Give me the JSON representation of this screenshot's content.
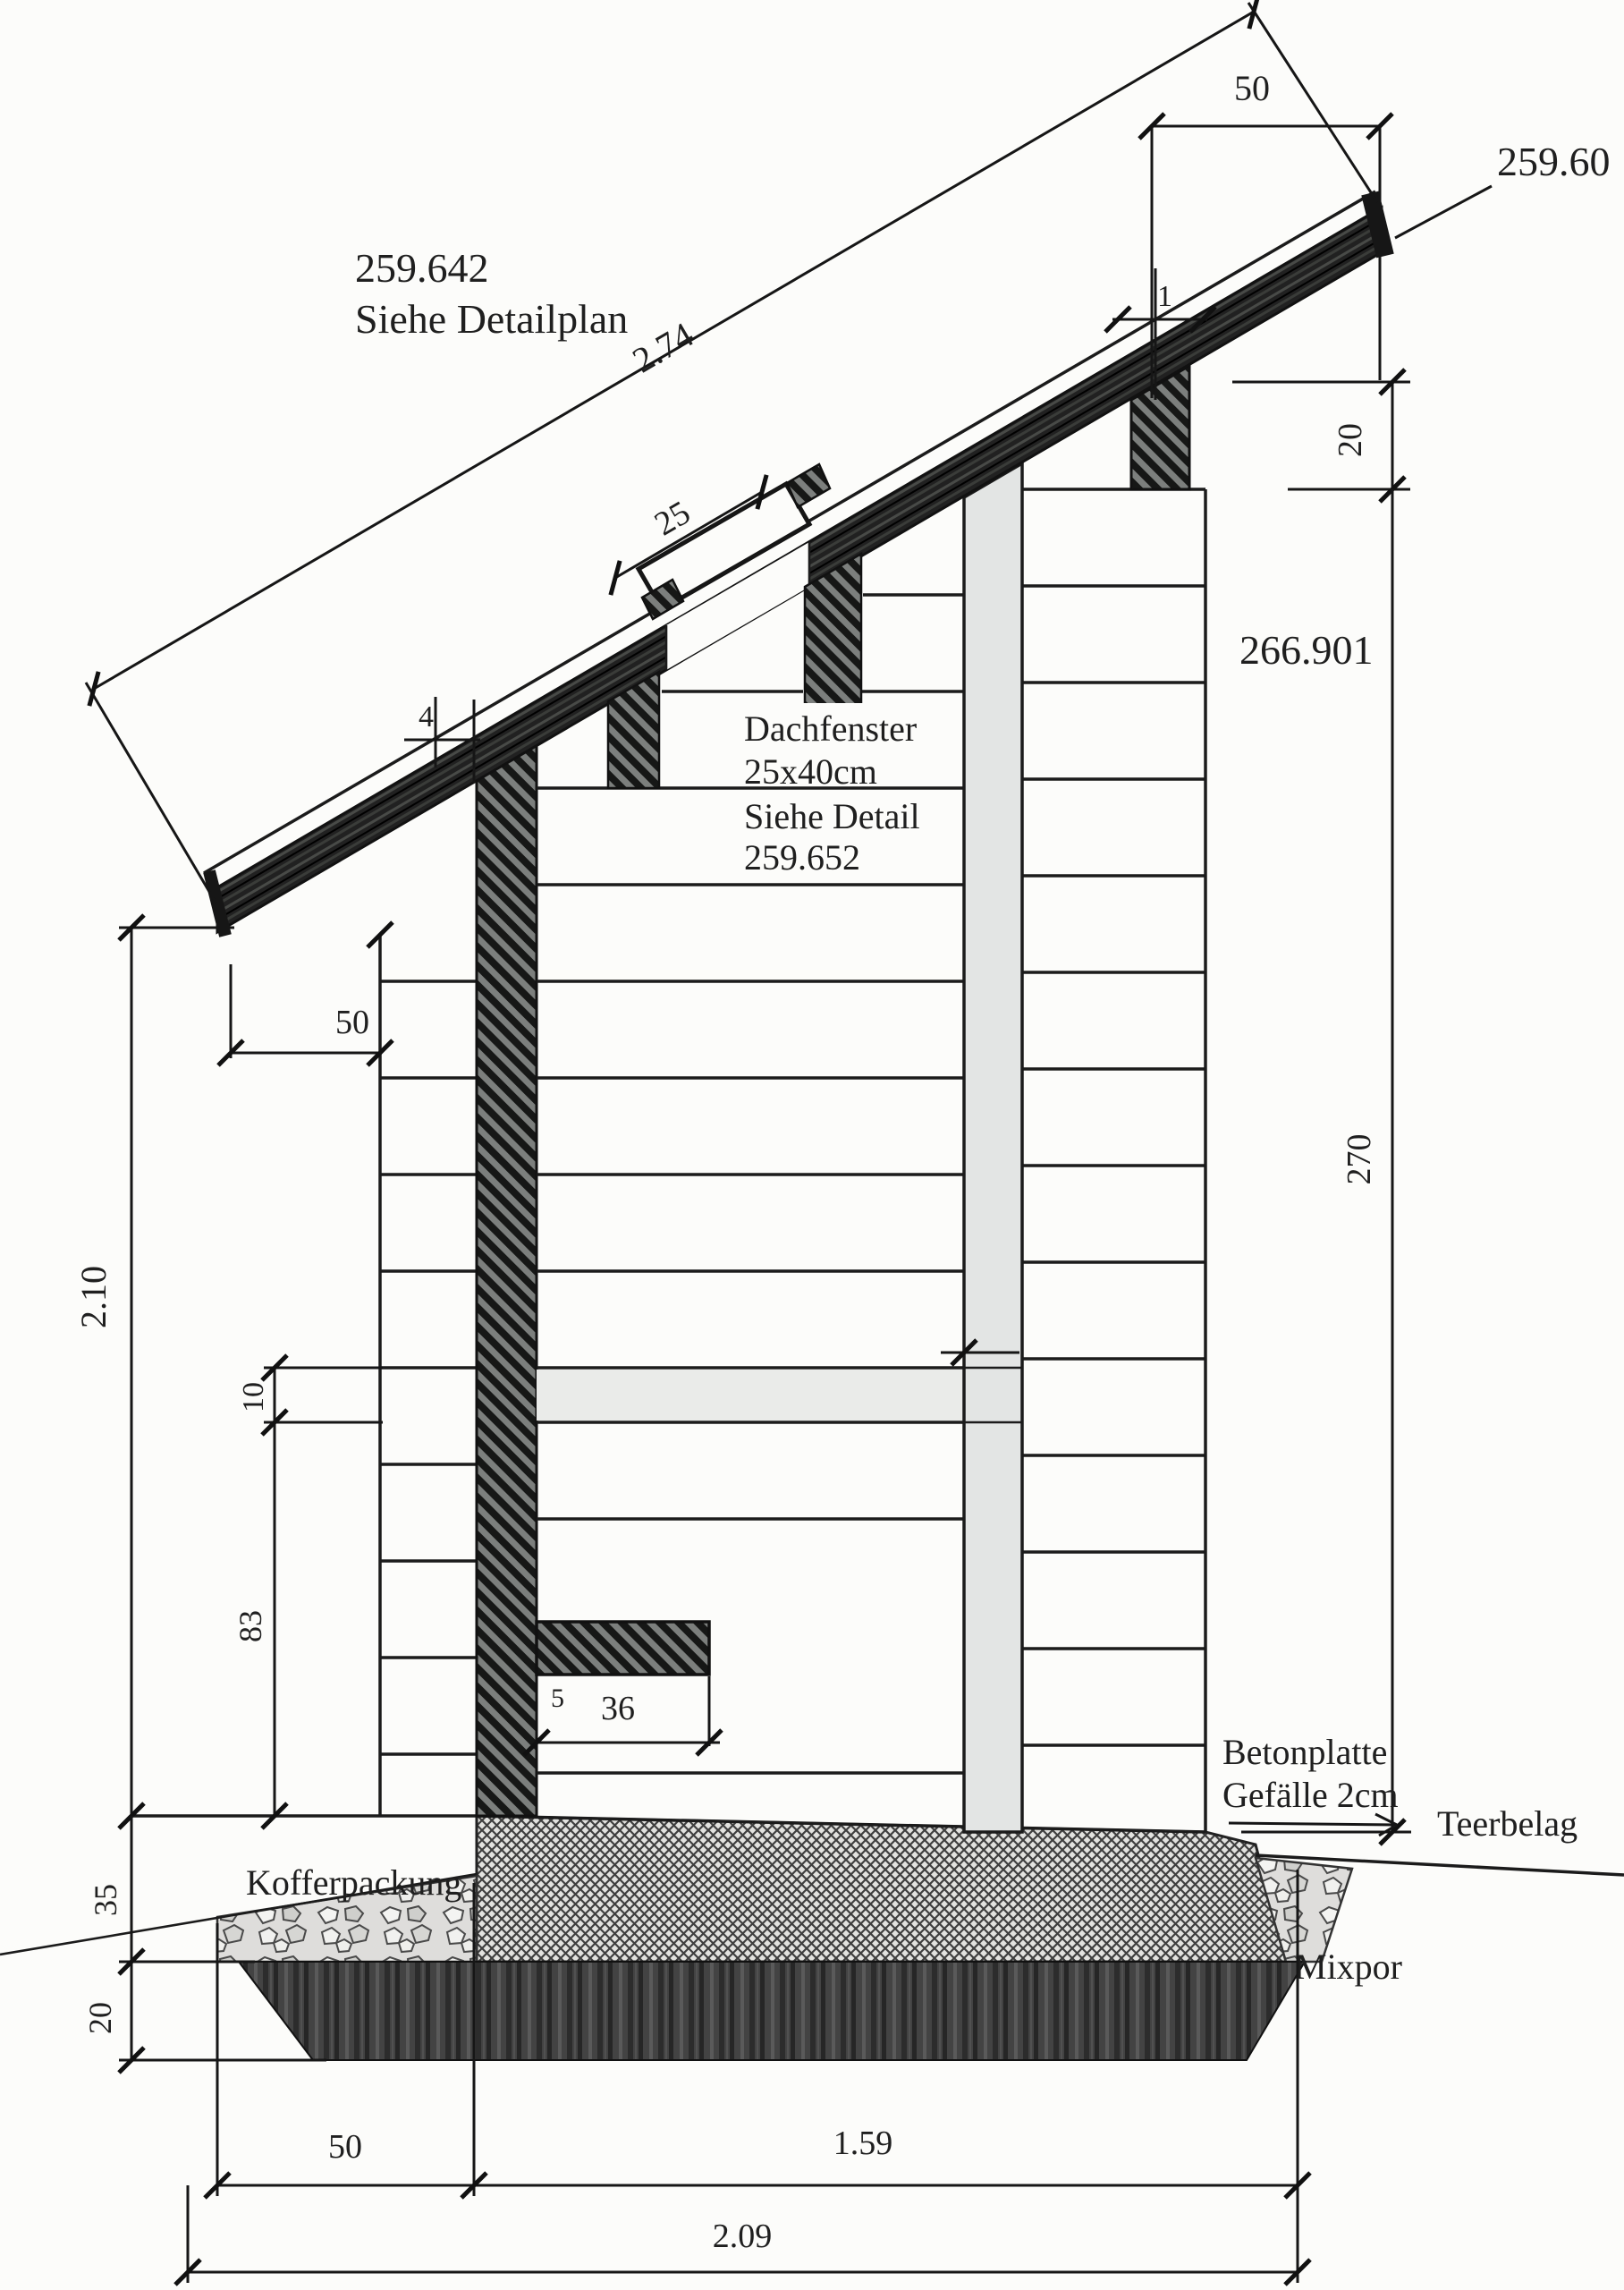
{
  "drawing": {
    "type": "architectural-section",
    "labels": {
      "elevation_top": "259.642",
      "see_detail_plan": "Siehe Detailplan",
      "elevation_eave": "259.60",
      "elevation_wall": "266.901",
      "roof_window": [
        "Dachfenster",
        "25x40cm",
        "Siehe Detail",
        "259.652"
      ],
      "concrete": [
        "Betonplatte",
        "Gefälle 2cm"
      ],
      "tar_surface": "Teerbelag",
      "gravel_packing": "Kofferpackung",
      "insulation_layer": "Mixpor"
    },
    "dims": {
      "roof_slope_length": "2.74",
      "ridge_offset": "50",
      "window_width": "25",
      "sheathing": "4",
      "batten": "1",
      "purlin_height": "20",
      "wall_height": "270",
      "eave_overhang": "50",
      "room_height": "2.10",
      "shelf_thickness": "10",
      "parapet": "83",
      "bench_inset": "5",
      "bench_depth": "36",
      "base_course": "35",
      "insulation": "20",
      "plinth": "50",
      "inner_width": "1.59",
      "total_width": "2.09"
    },
    "colors": {
      "paper": "#fcfcfa",
      "ink": "#1b1b1b",
      "column_fill": "#e3e5e4",
      "shelf_fill": "#eaebe9"
    }
  }
}
